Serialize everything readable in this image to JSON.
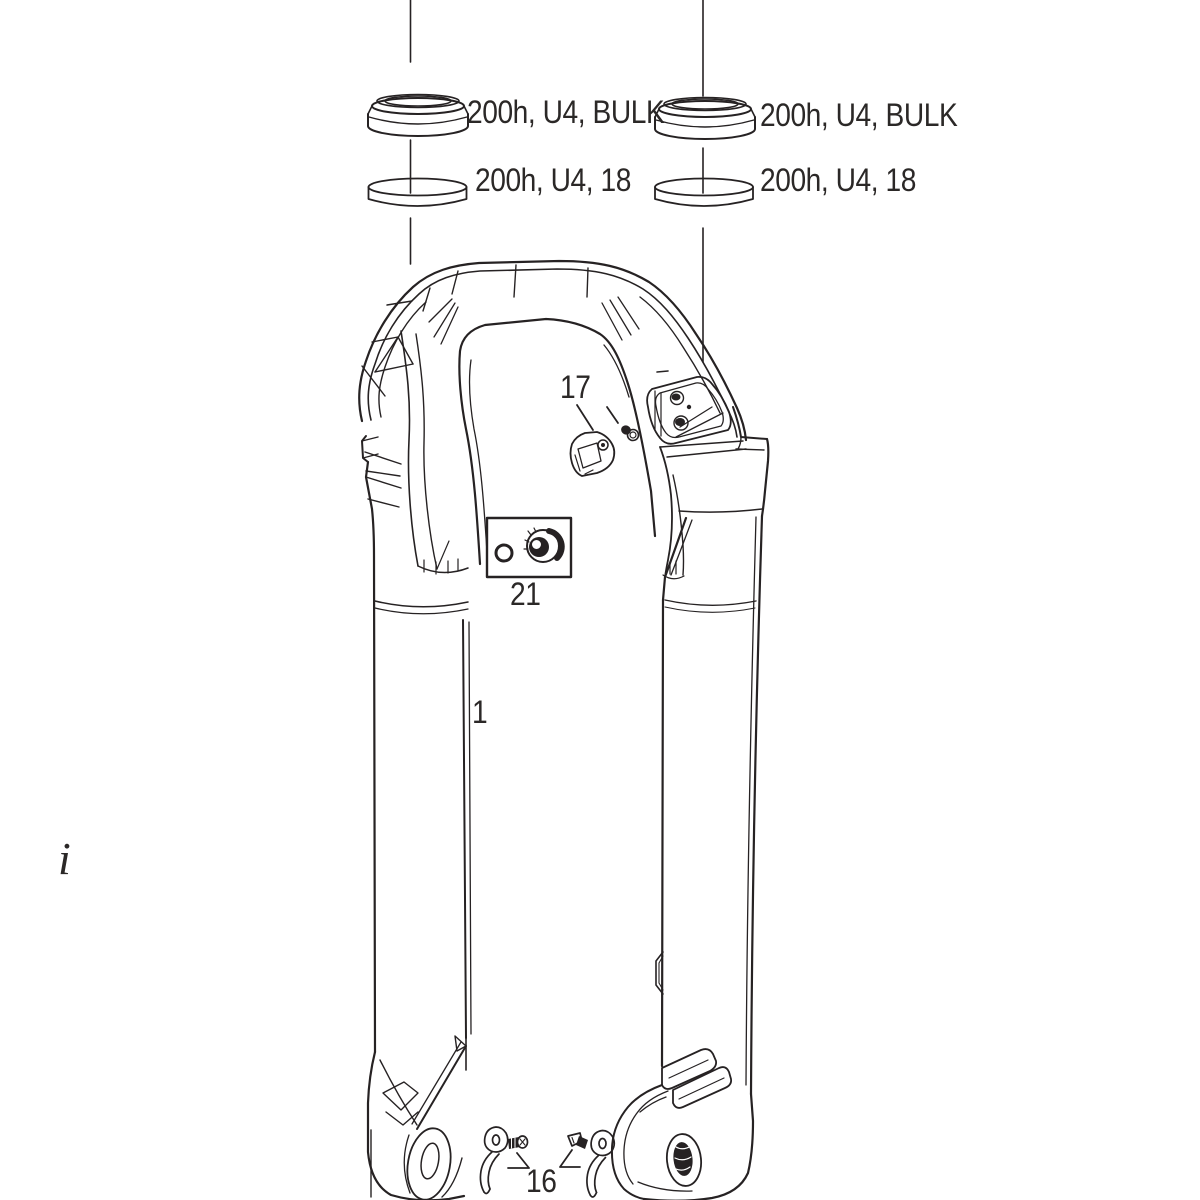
{
  "figure": {
    "background": "#ffffff",
    "ink": "#262223",
    "text_color": "#2b2827",
    "kind": "exploded-parts-line-drawing"
  },
  "callouts": {
    "left_dust_seal": "200h, U4, BULK",
    "left_foam_ring": "200h, U4, 18",
    "right_dust_seal": "200h, U4, BULK",
    "right_foam_ring": "200h, U4, 18"
  },
  "part_numbers": {
    "part_17": "17",
    "part_21": "21",
    "part_1": "1",
    "part_16": "16"
  },
  "edge_text_fragment": "i"
}
